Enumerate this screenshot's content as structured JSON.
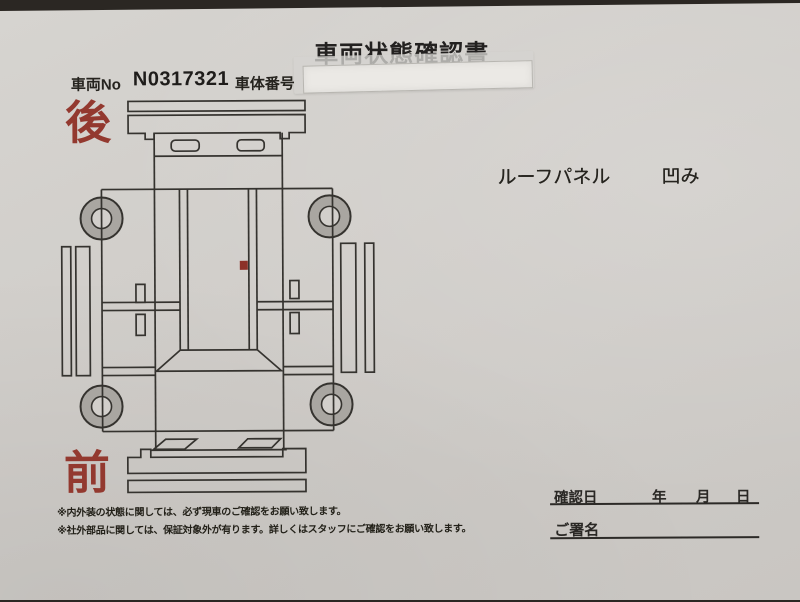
{
  "document": {
    "title": "車両状態確認書",
    "vehicle": {
      "no_label": "車両No",
      "no_value": "N0317321",
      "body_no_label": "車体番号"
    },
    "orientation": {
      "rear": "後",
      "front": "前"
    },
    "damage": {
      "part": "ルーフパネル",
      "condition": "凹み"
    },
    "confirmation": {
      "date_label": "確認日",
      "year_label": "年",
      "month_label": "月",
      "day_label": "日",
      "signature_label": "ご署名"
    },
    "notes": [
      "※内外装の状態に関しては、必ず現車のご確認をお願い致します。",
      "※社外部品に関しては、保証対象外が有ります。詳しくはスタッフにご確認をお願い致します。"
    ],
    "colors": {
      "accent_red": "#93392f",
      "dent_mark": "#8c3128",
      "ink": "#2a2825",
      "paper": "#d0cdc9",
      "wheel_gray": "#a9a6a1"
    }
  }
}
